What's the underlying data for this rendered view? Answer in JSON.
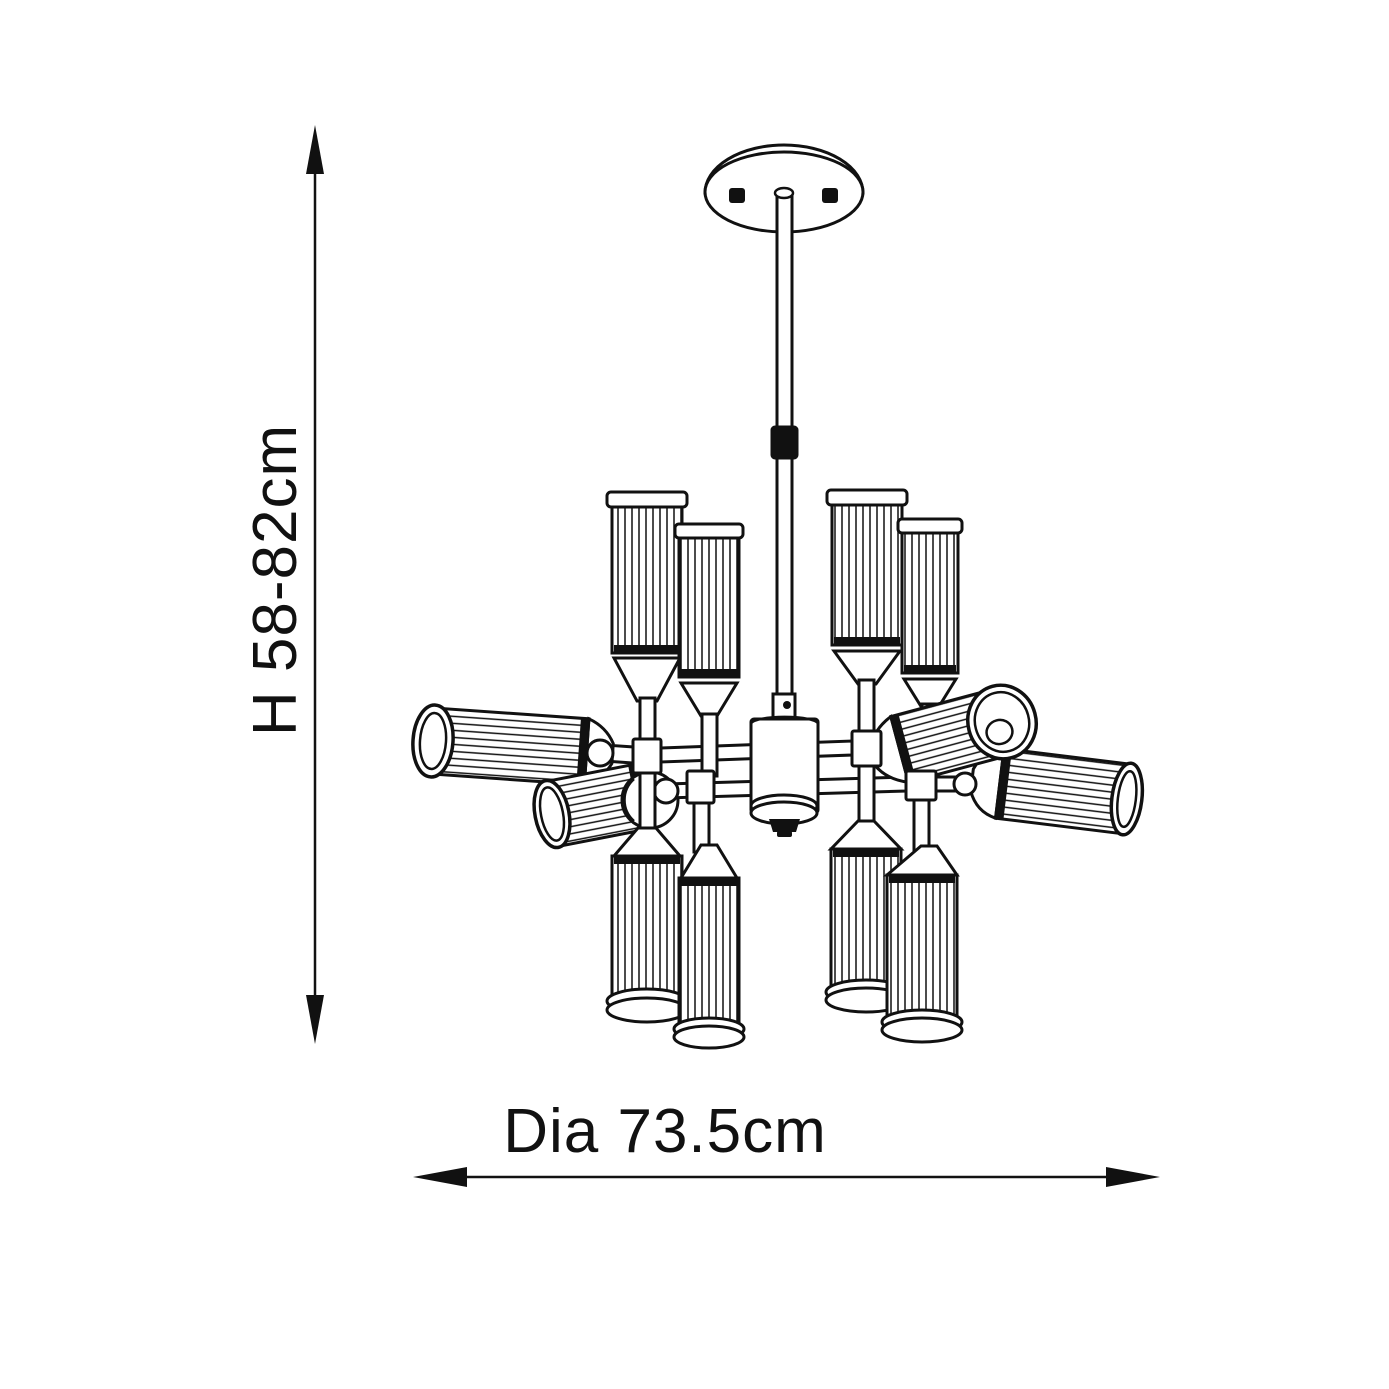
{
  "page": {
    "background": "#ffffff",
    "ink": "#111111"
  },
  "diagram": {
    "title": "Chandelier line drawing with dimensions",
    "height_label": "H 58-82cm",
    "diameter_label": "Dia 73.5cm",
    "shade_count": 12
  }
}
